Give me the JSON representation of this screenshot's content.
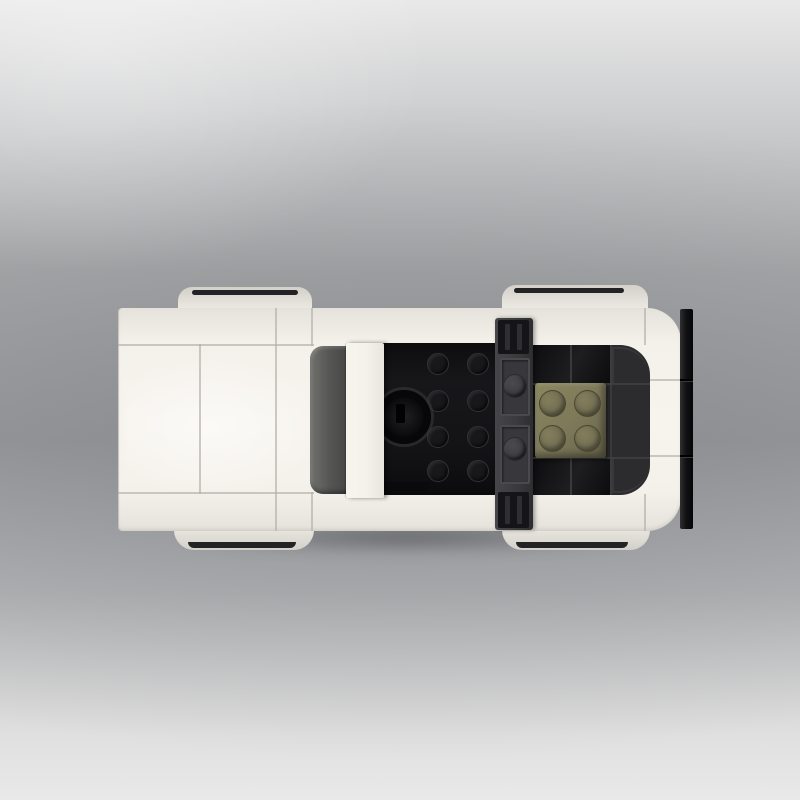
{
  "scene": {
    "subject": "top-down studio render of a white brick-built toy sports car",
    "orientation": "front of car at left, rear wing at right",
    "parts": [
      {
        "name": "hood",
        "color": "#f5f2ec"
      },
      {
        "name": "front-wheels",
        "color": "#eceae3",
        "tire_color": "#232326"
      },
      {
        "name": "windshield",
        "color": "#3d3d3b"
      },
      {
        "name": "roof-bar",
        "color": "#f4f1ea"
      },
      {
        "name": "cockpit",
        "color": "#17171a"
      },
      {
        "name": "steering-wheel",
        "color": "#070708"
      },
      {
        "name": "roll-bar",
        "color": "#3b3b3e"
      },
      {
        "name": "seat",
        "color": "#7c7859"
      },
      {
        "name": "engine-deck",
        "color": "#2c2c2e"
      },
      {
        "name": "rear-wheels",
        "color": "#eceae3",
        "tire_color": "#232326"
      },
      {
        "name": "rear-wing",
        "color": "#121214"
      }
    ]
  },
  "colors": {
    "bg_top": "#e9e9e9",
    "bg_upper": "#c6c7c9",
    "bg_mid": "#a7a9ab",
    "bg_core": "#9b9da0",
    "bg_lower": "#b4b5b7",
    "bg_bottom": "#e0e0e0",
    "body": "#f4f1eb",
    "body_edge": "#e5e2db",
    "panel_line": "#b2afa9",
    "mudguard": "#eceae3",
    "mudguard_shadow": "#d3d0c9",
    "tire": "#232326",
    "windshield_l": "#71716d",
    "windshield_d": "#3d3d3b",
    "bar_white": "#f4f1ea",
    "cockpit": "#17171a",
    "stud_edge": "#323236",
    "wheel_black": "#070708",
    "rollbar": "#3b3b3e",
    "rollbar_plate": "#38383c",
    "rollbar_stud": "#4b4b4f",
    "clip": "#151517",
    "seat": "#7c7859",
    "seat_hi": "#8b875f",
    "seat_stud": "#827e5c",
    "engine": "#2c2c2e",
    "engine_seam": "#414144",
    "engine_gloss": "#0c0c0e",
    "wing": "#121214",
    "wing_hi": "#303033"
  }
}
